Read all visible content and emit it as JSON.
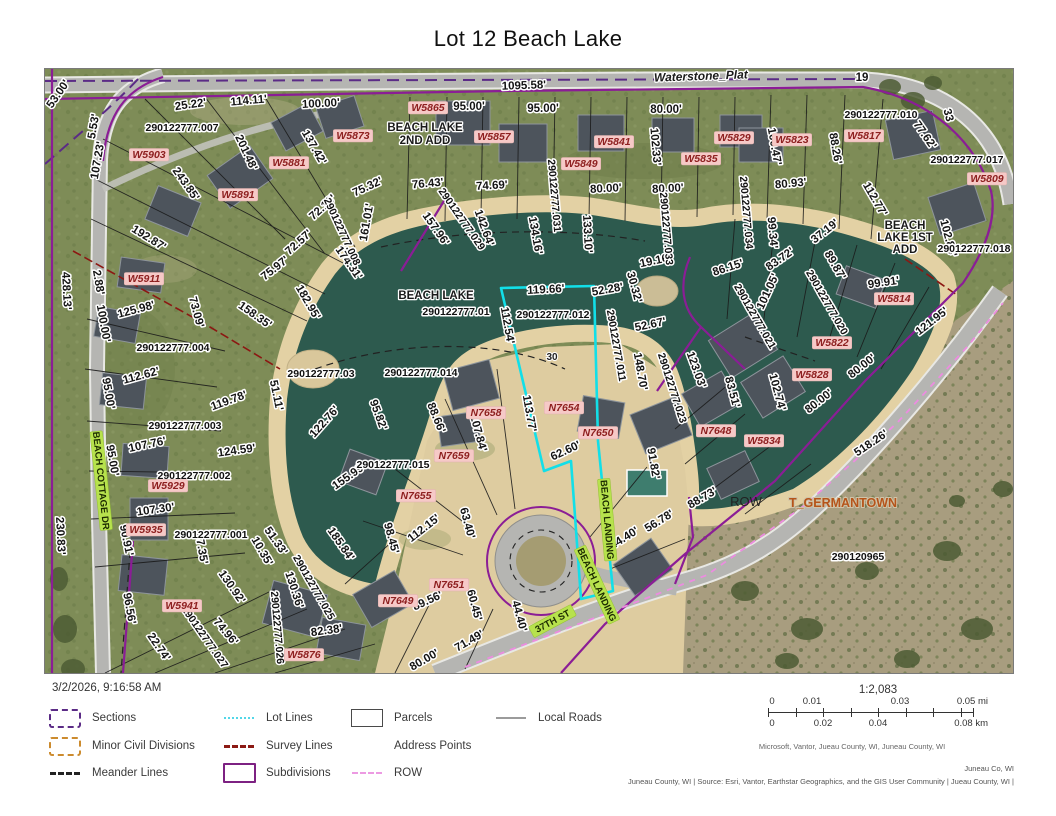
{
  "title": "Lot 12 Beach Lake",
  "timestamp": "3/2/2026, 9:16:58 AM",
  "legend": {
    "items": [
      {
        "label": "Sections"
      },
      {
        "label": "Minor Civil Divisions"
      },
      {
        "label": "Meander Lines"
      },
      {
        "label": "Lot Lines"
      },
      {
        "label": "Survey Lines"
      },
      {
        "label": "Subdivisions"
      },
      {
        "label": "Parcels"
      },
      {
        "label": "Address Points"
      },
      {
        "label": "ROW"
      },
      {
        "label": "Local Roads"
      }
    ]
  },
  "scalebar": {
    "ratio": "1:2,083",
    "mi": [
      "0",
      "0.01",
      "0.03",
      "0.05 mi"
    ],
    "km": [
      "0",
      "0.02",
      "0.04",
      "0.08 km"
    ]
  },
  "attribution": {
    "scalebar_credit": "Microsoft, Vantor, Jueau County, WI, Juneau County, WI",
    "county": "Juneau Co, WI",
    "sources": "Juneau County, WI | Source: Esri, Vantor, Earthstar Geographics, and the GIS User Community | Jueau County, WI |"
  },
  "map": {
    "colors": {
      "water": "#2d5a4e",
      "beach": "#e3d1a4",
      "grass": "#7e8c57",
      "scrub": "#a89d7f",
      "road": "#b5b5b2",
      "subdivision": "#8b1d96",
      "selection": "#12dfe8",
      "survey": "#8c1712",
      "row": "#ec8ce0",
      "address_bg": "#f6c9c7",
      "roadlabel_bg": "#b7e24d"
    },
    "labels": [
      {
        "t": "53.00'",
        "x": 16,
        "y": 27,
        "r": -55
      },
      {
        "t": "25.22'",
        "x": 146,
        "y": 39,
        "r": -8
      },
      {
        "t": "114.11'",
        "x": 204,
        "y": 35,
        "r": -5
      },
      {
        "t": "100.00'",
        "x": 276,
        "y": 38,
        "r": -3
      },
      {
        "t": "1095.58'",
        "x": 479,
        "y": 20,
        "r": -2
      },
      {
        "t": "95.00'",
        "x": 424,
        "y": 41,
        "r": 0
      },
      {
        "t": "95.00'",
        "x": 498,
        "y": 43,
        "r": 0
      },
      {
        "t": "80.00'",
        "x": 621,
        "y": 44,
        "r": 0
      },
      {
        "t": "137.42'",
        "x": 266,
        "y": 80,
        "r": 60
      },
      {
        "t": "102.33'",
        "x": 607,
        "y": 78,
        "r": 85
      },
      {
        "t": "100.47'",
        "x": 726,
        "y": 78,
        "r": 80
      },
      {
        "t": "88.26'",
        "x": 787,
        "y": 80,
        "r": 80
      },
      {
        "t": "201.48'",
        "x": 198,
        "y": 85,
        "r": 65
      },
      {
        "t": "75.32'",
        "x": 324,
        "y": 121,
        "r": -25
      },
      {
        "t": "76.43'",
        "x": 383,
        "y": 118,
        "r": -5
      },
      {
        "t": "74.69'",
        "x": 447,
        "y": 120,
        "r": -3
      },
      {
        "t": "80.00'",
        "x": 561,
        "y": 123,
        "r": -3
      },
      {
        "t": "80.00'",
        "x": 623,
        "y": 123,
        "r": -3
      },
      {
        "t": "80.93'",
        "x": 746,
        "y": 118,
        "r": -5
      },
      {
        "t": "77.62'",
        "x": 877,
        "y": 68,
        "r": 55
      },
      {
        "t": "112.77'",
        "x": 827,
        "y": 132,
        "r": 60
      },
      {
        "t": "243.85'",
        "x": 138,
        "y": 117,
        "r": 55
      },
      {
        "t": "72.18'",
        "x": 280,
        "y": 141,
        "r": -42
      },
      {
        "t": "161.01'",
        "x": 325,
        "y": 154,
        "r": -80
      },
      {
        "t": "157.96'",
        "x": 388,
        "y": 162,
        "r": 55
      },
      {
        "t": "142.64'",
        "x": 436,
        "y": 160,
        "r": 70
      },
      {
        "t": "134.16'",
        "x": 487,
        "y": 167,
        "r": 80
      },
      {
        "t": "133.10'",
        "x": 539,
        "y": 165,
        "r": 87
      },
      {
        "t": "72.57'",
        "x": 256,
        "y": 176,
        "r": -42
      },
      {
        "t": "174.31'",
        "x": 301,
        "y": 196,
        "r": 55
      },
      {
        "t": "75.97'",
        "x": 232,
        "y": 202,
        "r": -38
      },
      {
        "t": "99.34'",
        "x": 724,
        "y": 164,
        "r": 85
      },
      {
        "t": "37.19'",
        "x": 782,
        "y": 165,
        "r": -38
      },
      {
        "t": "89.87'",
        "x": 787,
        "y": 198,
        "r": 60
      },
      {
        "t": "83.72'",
        "x": 737,
        "y": 193,
        "r": -35
      },
      {
        "t": "86.15'",
        "x": 684,
        "y": 202,
        "r": -18
      },
      {
        "t": "99.91'",
        "x": 839,
        "y": 217,
        "r": -8
      },
      {
        "t": "19.16'",
        "x": 611,
        "y": 195,
        "r": -12
      },
      {
        "t": "30.32'",
        "x": 586,
        "y": 219,
        "r": 75
      },
      {
        "t": "52.28'",
        "x": 563,
        "y": 224,
        "r": -10
      },
      {
        "t": "119.66'",
        "x": 501,
        "y": 224,
        "r": -3
      },
      {
        "t": "112.54'",
        "x": 459,
        "y": 257,
        "r": 80
      },
      {
        "t": "52.67'",
        "x": 606,
        "y": 259,
        "r": -12
      },
      {
        "t": "101.05'",
        "x": 726,
        "y": 224,
        "r": -65
      },
      {
        "t": "121.95'",
        "x": 889,
        "y": 255,
        "r": -38
      },
      {
        "t": "102.84'",
        "x": 900,
        "y": 170,
        "r": 75
      },
      {
        "t": "5.53'",
        "x": 52,
        "y": 58,
        "r": -80
      },
      {
        "t": "107.23'",
        "x": 56,
        "y": 92,
        "r": -80
      },
      {
        "t": "192.87'",
        "x": 102,
        "y": 172,
        "r": 32
      },
      {
        "t": "2.88'",
        "x": 50,
        "y": 214,
        "r": 80
      },
      {
        "t": "428.13'",
        "x": 18,
        "y": 222,
        "r": 87
      },
      {
        "t": "100.00'",
        "x": 55,
        "y": 255,
        "r": 80
      },
      {
        "t": "125.98'",
        "x": 92,
        "y": 244,
        "r": -15
      },
      {
        "t": "73.09'",
        "x": 148,
        "y": 244,
        "r": 75
      },
      {
        "t": "158.35'",
        "x": 208,
        "y": 249,
        "r": 35
      },
      {
        "t": "182.95'",
        "x": 260,
        "y": 235,
        "r": 60
      },
      {
        "t": "95.00'",
        "x": 60,
        "y": 325,
        "r": 80
      },
      {
        "t": "112.62'",
        "x": 97,
        "y": 310,
        "r": -15
      },
      {
        "t": "119.78'",
        "x": 185,
        "y": 335,
        "r": -20
      },
      {
        "t": "51.11'",
        "x": 228,
        "y": 327,
        "r": 78
      },
      {
        "t": "122.76'",
        "x": 282,
        "y": 355,
        "r": -48
      },
      {
        "t": "95.82'",
        "x": 330,
        "y": 347,
        "r": 70
      },
      {
        "t": "148.70'",
        "x": 592,
        "y": 303,
        "r": 80
      },
      {
        "t": "123.03'",
        "x": 648,
        "y": 302,
        "r": 70
      },
      {
        "t": "83.51'",
        "x": 684,
        "y": 324,
        "r": 75
      },
      {
        "t": "102.74'",
        "x": 729,
        "y": 324,
        "r": 75
      },
      {
        "t": "80.00'",
        "x": 819,
        "y": 300,
        "r": -38
      },
      {
        "t": "80.00'",
        "x": 776,
        "y": 335,
        "r": -38
      },
      {
        "t": "107.76'",
        "x": 103,
        "y": 379,
        "r": -12
      },
      {
        "t": "95.00'",
        "x": 64,
        "y": 392,
        "r": 80
      },
      {
        "t": "124.59'",
        "x": 192,
        "y": 385,
        "r": -8
      },
      {
        "t": "113.77'",
        "x": 481,
        "y": 345,
        "r": 80
      },
      {
        "t": "88.66'",
        "x": 388,
        "y": 350,
        "r": 68
      },
      {
        "t": "107.84'",
        "x": 430,
        "y": 365,
        "r": 75
      },
      {
        "t": "91.82'",
        "x": 605,
        "y": 395,
        "r": 80
      },
      {
        "t": "62.60'",
        "x": 522,
        "y": 385,
        "r": -25
      },
      {
        "t": "155.99'",
        "x": 306,
        "y": 410,
        "r": -35
      },
      {
        "t": "107.30'",
        "x": 111,
        "y": 444,
        "r": -8
      },
      {
        "t": "90.91'",
        "x": 78,
        "y": 472,
        "r": 78
      },
      {
        "t": "87.35'",
        "x": 153,
        "y": 480,
        "r": 80
      },
      {
        "t": "230.83'",
        "x": 12,
        "y": 467,
        "r": 87
      },
      {
        "t": "10.35'",
        "x": 214,
        "y": 484,
        "r": 60
      },
      {
        "t": "51.33'",
        "x": 228,
        "y": 474,
        "r": 55
      },
      {
        "t": "130.92'",
        "x": 184,
        "y": 520,
        "r": 55
      },
      {
        "t": "130.36'",
        "x": 246,
        "y": 522,
        "r": 72
      },
      {
        "t": "185.84'",
        "x": 293,
        "y": 477,
        "r": 55
      },
      {
        "t": "98.45'",
        "x": 343,
        "y": 470,
        "r": 75
      },
      {
        "t": "112.15'",
        "x": 381,
        "y": 462,
        "r": -38
      },
      {
        "t": "63.40'",
        "x": 419,
        "y": 455,
        "r": 75
      },
      {
        "t": "96.56'",
        "x": 81,
        "y": 540,
        "r": 80
      },
      {
        "t": "74.96'",
        "x": 178,
        "y": 565,
        "r": 50
      },
      {
        "t": "22.74'",
        "x": 111,
        "y": 580,
        "r": 55
      },
      {
        "t": "82.38'",
        "x": 282,
        "y": 565,
        "r": -8
      },
      {
        "t": "60.45'",
        "x": 426,
        "y": 537,
        "r": 75
      },
      {
        "t": "89.56'",
        "x": 384,
        "y": 535,
        "r": -25
      },
      {
        "t": "44.40'",
        "x": 471,
        "y": 548,
        "r": 75
      },
      {
        "t": "71.49'",
        "x": 426,
        "y": 575,
        "r": -30
      },
      {
        "t": "80.00'",
        "x": 381,
        "y": 594,
        "r": -30
      },
      {
        "t": "44.40'",
        "x": 581,
        "y": 472,
        "r": -32
      },
      {
        "t": "56.78'",
        "x": 616,
        "y": 455,
        "r": -32
      },
      {
        "t": "88.73'",
        "x": 659,
        "y": 432,
        "r": -30
      },
      {
        "t": "518.26'",
        "x": 828,
        "y": 377,
        "r": -34
      },
      {
        "t": "19",
        "x": 817,
        "y": 12,
        "r": 0
      },
      {
        "t": "33",
        "x": 900,
        "y": 47,
        "r": 75
      },
      {
        "t": "290122777.007",
        "x": 137,
        "y": 62,
        "c": "pid"
      },
      {
        "t": "290122777.010",
        "x": 836,
        "y": 49,
        "c": "pid"
      },
      {
        "t": "290122777.017",
        "x": 922,
        "y": 94,
        "c": "pid"
      },
      {
        "t": "290122777.018",
        "x": 929,
        "y": 183,
        "c": "pid"
      },
      {
        "t": "290122777.034",
        "x": 698,
        "y": 144,
        "r": 85,
        "c": "pid"
      },
      {
        "t": "290122777.033",
        "x": 618,
        "y": 160,
        "r": 85,
        "c": "pid"
      },
      {
        "t": "290122777.031",
        "x": 506,
        "y": 127,
        "r": 85,
        "c": "pid"
      },
      {
        "t": "290122777.029",
        "x": 414,
        "y": 152,
        "r": 55,
        "c": "pid"
      },
      {
        "t": "290122777.008",
        "x": 294,
        "y": 164,
        "r": 65,
        "c": "pid"
      },
      {
        "t": "290122777.004",
        "x": 128,
        "y": 282,
        "c": "pid"
      },
      {
        "t": "290122777.03",
        "x": 276,
        "y": 308,
        "c": "pid"
      },
      {
        "t": "290122777.014",
        "x": 376,
        "y": 307,
        "c": "pid"
      },
      {
        "t": "290122777.012",
        "x": 508,
        "y": 249,
        "c": "pid"
      },
      {
        "t": "290122777.01",
        "x": 411,
        "y": 246,
        "c": "pid"
      },
      {
        "t": "290122777.011",
        "x": 568,
        "y": 277,
        "r": 80,
        "c": "pid"
      },
      {
        "t": "290122777.020",
        "x": 779,
        "y": 235,
        "r": 60,
        "c": "pid"
      },
      {
        "t": "290122777.021",
        "x": 707,
        "y": 249,
        "r": 60,
        "c": "pid"
      },
      {
        "t": "290122777.023",
        "x": 624,
        "y": 320,
        "r": 72,
        "c": "pid"
      },
      {
        "t": "290122777.003",
        "x": 140,
        "y": 360,
        "c": "pid"
      },
      {
        "t": "290122777.002",
        "x": 149,
        "y": 410,
        "c": "pid"
      },
      {
        "t": "290122777.015",
        "x": 348,
        "y": 399,
        "c": "pid"
      },
      {
        "t": "290122777.001",
        "x": 166,
        "y": 469,
        "c": "pid"
      },
      {
        "t": "290122777.027",
        "x": 157,
        "y": 570,
        "r": 55,
        "c": "pid"
      },
      {
        "t": "290122777.026",
        "x": 229,
        "y": 559,
        "r": 85,
        "c": "pid"
      },
      {
        "t": "290122777.025",
        "x": 266,
        "y": 520,
        "r": 60,
        "c": "pid"
      },
      {
        "t": "290120965",
        "x": 813,
        "y": 491,
        "c": "pid"
      },
      {
        "t": "W5903",
        "x": 104,
        "y": 89,
        "c": "addr"
      },
      {
        "t": "W5873",
        "x": 308,
        "y": 70,
        "c": "addr"
      },
      {
        "t": "W5881",
        "x": 244,
        "y": 97,
        "c": "addr"
      },
      {
        "t": "W5891",
        "x": 193,
        "y": 129,
        "c": "addr"
      },
      {
        "t": "W5911",
        "x": 99,
        "y": 213,
        "c": "addr"
      },
      {
        "t": "W5865",
        "x": 383,
        "y": 42,
        "c": "addr"
      },
      {
        "t": "W5857",
        "x": 449,
        "y": 71,
        "c": "addr"
      },
      {
        "t": "W5841",
        "x": 569,
        "y": 76,
        "c": "addr"
      },
      {
        "t": "W5849",
        "x": 536,
        "y": 98,
        "c": "addr"
      },
      {
        "t": "W5835",
        "x": 656,
        "y": 93,
        "c": "addr"
      },
      {
        "t": "W5829",
        "x": 689,
        "y": 72,
        "c": "addr"
      },
      {
        "t": "W5823",
        "x": 747,
        "y": 74,
        "c": "addr"
      },
      {
        "t": "W5817",
        "x": 819,
        "y": 70,
        "c": "addr"
      },
      {
        "t": "W5809",
        "x": 942,
        "y": 113,
        "c": "addr"
      },
      {
        "t": "W5814",
        "x": 849,
        "y": 233,
        "c": "addr"
      },
      {
        "t": "W5822",
        "x": 787,
        "y": 277,
        "c": "addr"
      },
      {
        "t": "W5828",
        "x": 767,
        "y": 309,
        "c": "addr"
      },
      {
        "t": "W5834",
        "x": 719,
        "y": 375,
        "c": "addr"
      },
      {
        "t": "N7648",
        "x": 671,
        "y": 365,
        "c": "addr"
      },
      {
        "t": "N7654",
        "x": 519,
        "y": 342,
        "c": "addr"
      },
      {
        "t": "N7650",
        "x": 553,
        "y": 367,
        "c": "addr"
      },
      {
        "t": "N7658",
        "x": 441,
        "y": 347,
        "c": "addr"
      },
      {
        "t": "N7659",
        "x": 409,
        "y": 390,
        "c": "addr"
      },
      {
        "t": "N7655",
        "x": 371,
        "y": 430,
        "c": "addr"
      },
      {
        "t": "N7651",
        "x": 404,
        "y": 519,
        "c": "addr"
      },
      {
        "t": "N7649",
        "x": 353,
        "y": 535,
        "c": "addr"
      },
      {
        "t": "W5929",
        "x": 123,
        "y": 420,
        "c": "addr"
      },
      {
        "t": "W5935",
        "x": 101,
        "y": 464,
        "c": "addr"
      },
      {
        "t": "W5941",
        "x": 137,
        "y": 540,
        "c": "addr"
      },
      {
        "t": "W5876",
        "x": 259,
        "y": 589,
        "c": "addr"
      },
      {
        "t": "BEACH COTTAGE DR",
        "x": 53,
        "y": 412,
        "r": 84,
        "c": "road"
      },
      {
        "t": "BEACH LANDING",
        "x": 559,
        "y": 451,
        "r": 85,
        "c": "road"
      },
      {
        "t": "BEACH LANDING",
        "x": 549,
        "y": 517,
        "r": 65,
        "c": "road"
      },
      {
        "t": "37TH ST",
        "x": 509,
        "y": 555,
        "r": -28,
        "c": "road"
      },
      {
        "t": "Waterstone_Plat",
        "x": 656,
        "y": 11,
        "r": -2,
        "c": "plati"
      },
      {
        "t": "BEACH LAKE",
        "x": 380,
        "y": 62,
        "c": "plat"
      },
      {
        "t": "2ND ADD",
        "x": 380,
        "y": 75,
        "c": "plat"
      },
      {
        "t": "BEACH LAKE",
        "x": 391,
        "y": 230,
        "c": "plat"
      },
      {
        "t": "BEACH",
        "x": 860,
        "y": 160,
        "c": "plat"
      },
      {
        "t": "LAKE 1ST",
        "x": 860,
        "y": 172,
        "c": "plat"
      },
      {
        "t": "ADD",
        "x": 860,
        "y": 184,
        "c": "plat"
      },
      {
        "t": "T_GERMANTOWN",
        "x": 798,
        "y": 438,
        "c": "town"
      },
      {
        "t": "ROW",
        "x": 701,
        "y": 437,
        "c": "misc"
      },
      {
        "t": "30",
        "x": 507,
        "y": 291,
        "c": "sm"
      }
    ]
  }
}
